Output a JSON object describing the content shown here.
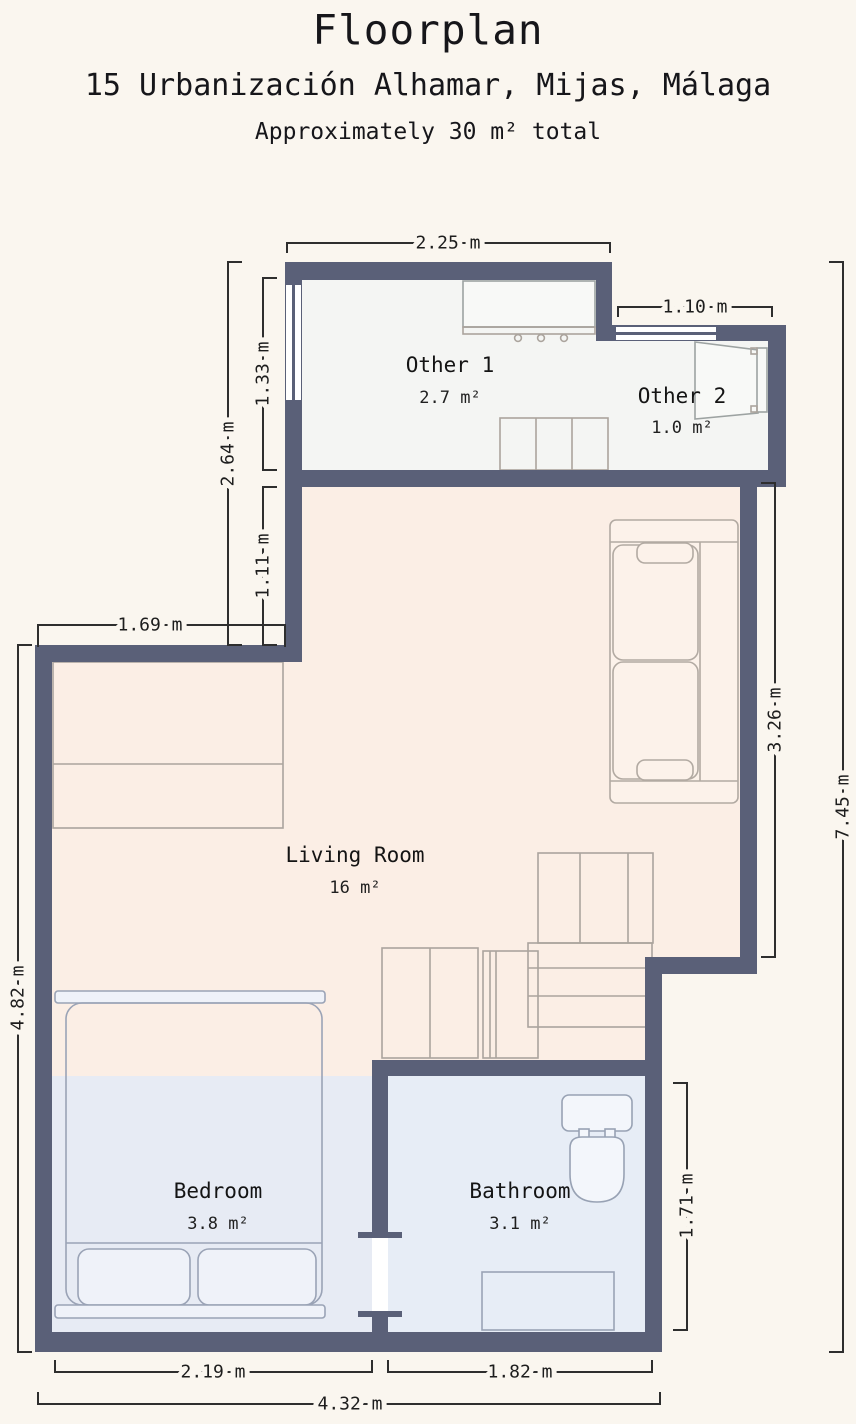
{
  "header": {
    "title": "Floorplan",
    "address": "15 Urbanización Alhamar, Mijas, Málaga",
    "total_area": "Approximately 30 m² total"
  },
  "rooms": {
    "other1": {
      "name": "Other 1",
      "area": "2.7 m²"
    },
    "other2": {
      "name": "Other 2",
      "area": "1.0 m²"
    },
    "living_room": {
      "name": "Living Room",
      "area": "16 m²"
    },
    "bedroom": {
      "name": "Bedroom",
      "area": "3.8 m²"
    },
    "bathroom": {
      "name": "Bathroom",
      "area": "3.1 m²"
    }
  },
  "dimensions": {
    "other1_width": "2.25 m",
    "other2_width": "1.10 m",
    "other1_window_side": "1.33 m",
    "upper_left_total": "2.64 m",
    "living_upper_left": "1.11 m",
    "living_step_width": "1.69 m",
    "living_left_height": "4.82 m",
    "living_right_height": "3.26 m",
    "total_height": "7.45 m",
    "bathroom_height": "1.71 m",
    "bedroom_width": "2.19 m",
    "bathroom_width": "1.82 m",
    "total_width": "4.32 m"
  },
  "colors": {
    "wall": "#5a6078",
    "background": "#faf6ef",
    "other_floor": "#f4f5f3",
    "living_floor": "#fbeee5",
    "bedroom_floor": "#e7ebf4",
    "bathroom_floor": "#e7edf6"
  }
}
